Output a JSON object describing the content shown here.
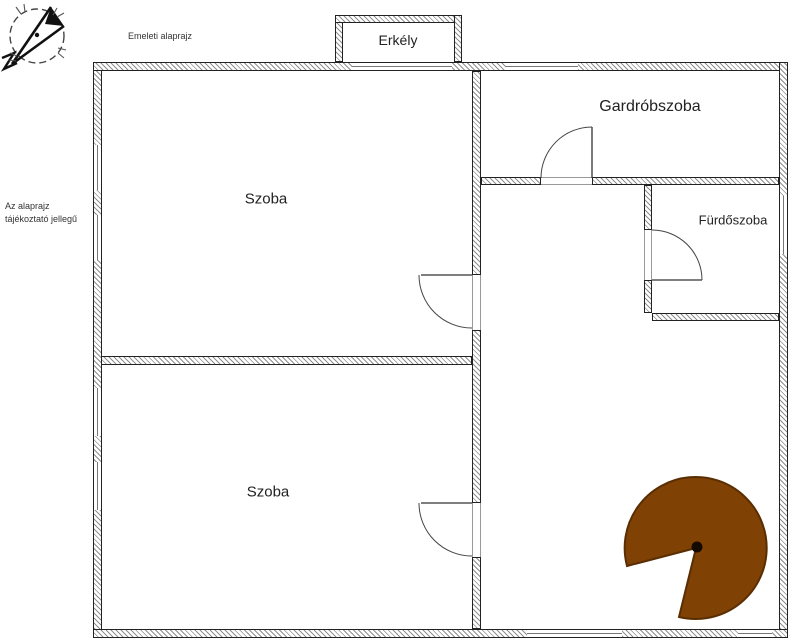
{
  "notes": {
    "plan_title": "Emeleti alaprajz",
    "disclaimer_line1": "Az alaprajz",
    "disclaimer_line2": "tájékoztató jellegű"
  },
  "rooms": {
    "erkely": {
      "label": "Erkély"
    },
    "szoba_felso": {
      "label": "Szoba"
    },
    "gardrobszoba": {
      "label": "Gardróbszoba"
    },
    "furdoszoba": {
      "label": "Fürdőszoba"
    },
    "szoba_also": {
      "label": "Szoba"
    }
  },
  "colors": {
    "stair_fill": "#7f4104",
    "stair_stroke": "#5a2e03",
    "wall_line": "#222222"
  }
}
